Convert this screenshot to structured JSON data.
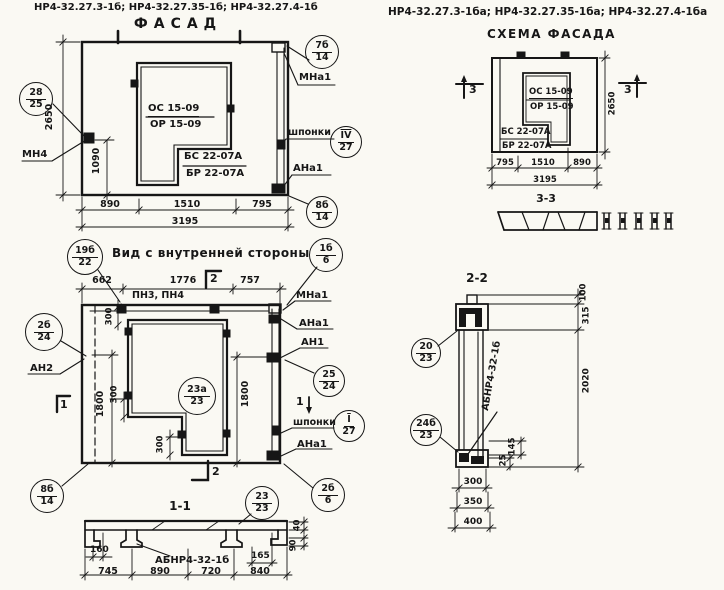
{
  "headers": {
    "left_codes": "НР4-32.27.3-1б; НР4-32.27.35-1б; НР4-32.27.4-1б",
    "facade_title": "ФАСАД",
    "right_codes": "НР4-32.27.3-1ба; НР4-32.27.35-1ба; НР4-32.27.4-1ба",
    "scheme_title": "СХЕМА ФАСАДА"
  },
  "facade": {
    "window_block_top": "ОС 15-09",
    "window_block_bottom": "ОР 15-09",
    "sill_block_top": "БС 22-07А",
    "sill_block_bottom": "БР 22-07А",
    "dim_height": "2650",
    "dim_anchor_height": "1090",
    "dim_w1": "890",
    "dim_w2": "1510",
    "dim_w3": "795",
    "dim_total": "3195",
    "label_mn4": "МН4",
    "label_mna1": "МНа1",
    "label_shponki": "шпонки",
    "label_ana1": "АНа1",
    "callout_left_top": "28",
    "callout_left_bottom": "25",
    "callout_tr_top": "7б",
    "callout_tr_bottom": "14",
    "callout_key_top": "IV",
    "callout_key_bottom": "27",
    "callout_br_top": "8б",
    "callout_br_bottom": "14"
  },
  "inner_view": {
    "title": "Вид с внутренней стороны",
    "dim_t1": "662",
    "dim_t2": "1776",
    "dim_t3": "757",
    "label_pn": "ПН3, ПН4",
    "label_mna1": "МНа1",
    "label_ana1_top": "АНа1",
    "label_an1": "АН1",
    "label_an2": "АН2",
    "label_shponki": "шпонки",
    "label_ana1_bottom": "АНа1",
    "dim_left_1800": "1800",
    "dim_right_1800": "1800",
    "dim_300_top": "300",
    "dim_300_mid": "300",
    "dim_300_bottom": "300",
    "sec1": "1",
    "sec2": "2",
    "callout_title_top": "19б",
    "callout_title_bottom": "22",
    "callout_tr_top": "1б",
    "callout_tr_bottom": "6",
    "callout_left_top": "2б",
    "callout_left_bottom": "24",
    "callout_opening_top": "23а",
    "callout_opening_bottom": "23",
    "callout_right_top": "25",
    "callout_right_bottom": "24",
    "callout_key_top": "I",
    "callout_key_bottom": "27",
    "callout_br_top": "2б",
    "callout_br_bottom": "6",
    "callout_bl_top": "8б",
    "callout_bl_bottom": "14"
  },
  "section11": {
    "title": "1-1",
    "callout_top": "23",
    "callout_bottom": "23",
    "label_panel": "АБНР4-32-1б",
    "dim_160": "160",
    "dim_165": "165",
    "dim_40": "40",
    "dim_90": "90",
    "dim_b1": "745",
    "dim_b2": "890",
    "dim_b3": "720",
    "dim_b4": "840"
  },
  "scheme": {
    "window_block_top": "ОС 15-09",
    "window_block_bottom": "ОР 15-09",
    "sill_block_top": "БС 22-07А",
    "sill_block_bottom": "БР 22-07А",
    "dim_w1": "795",
    "dim_w2": "1510",
    "dim_w3": "890",
    "dim_total": "3195",
    "dim_height": "2650",
    "sec3": "3",
    "section_title": "3-3"
  },
  "section22": {
    "title": "2-2",
    "dim_100": "100",
    "dim_315": "315",
    "dim_2020": "2020",
    "dim_145": "145",
    "dim_25": "25",
    "dim_b1": "300",
    "dim_b2": "350",
    "dim_b3": "400",
    "label_panel": "АБНР4-32-1б",
    "callout_top_top": "20",
    "callout_top_bottom": "23",
    "callout_bot_top": "24б",
    "callout_bot_bottom": "23"
  }
}
